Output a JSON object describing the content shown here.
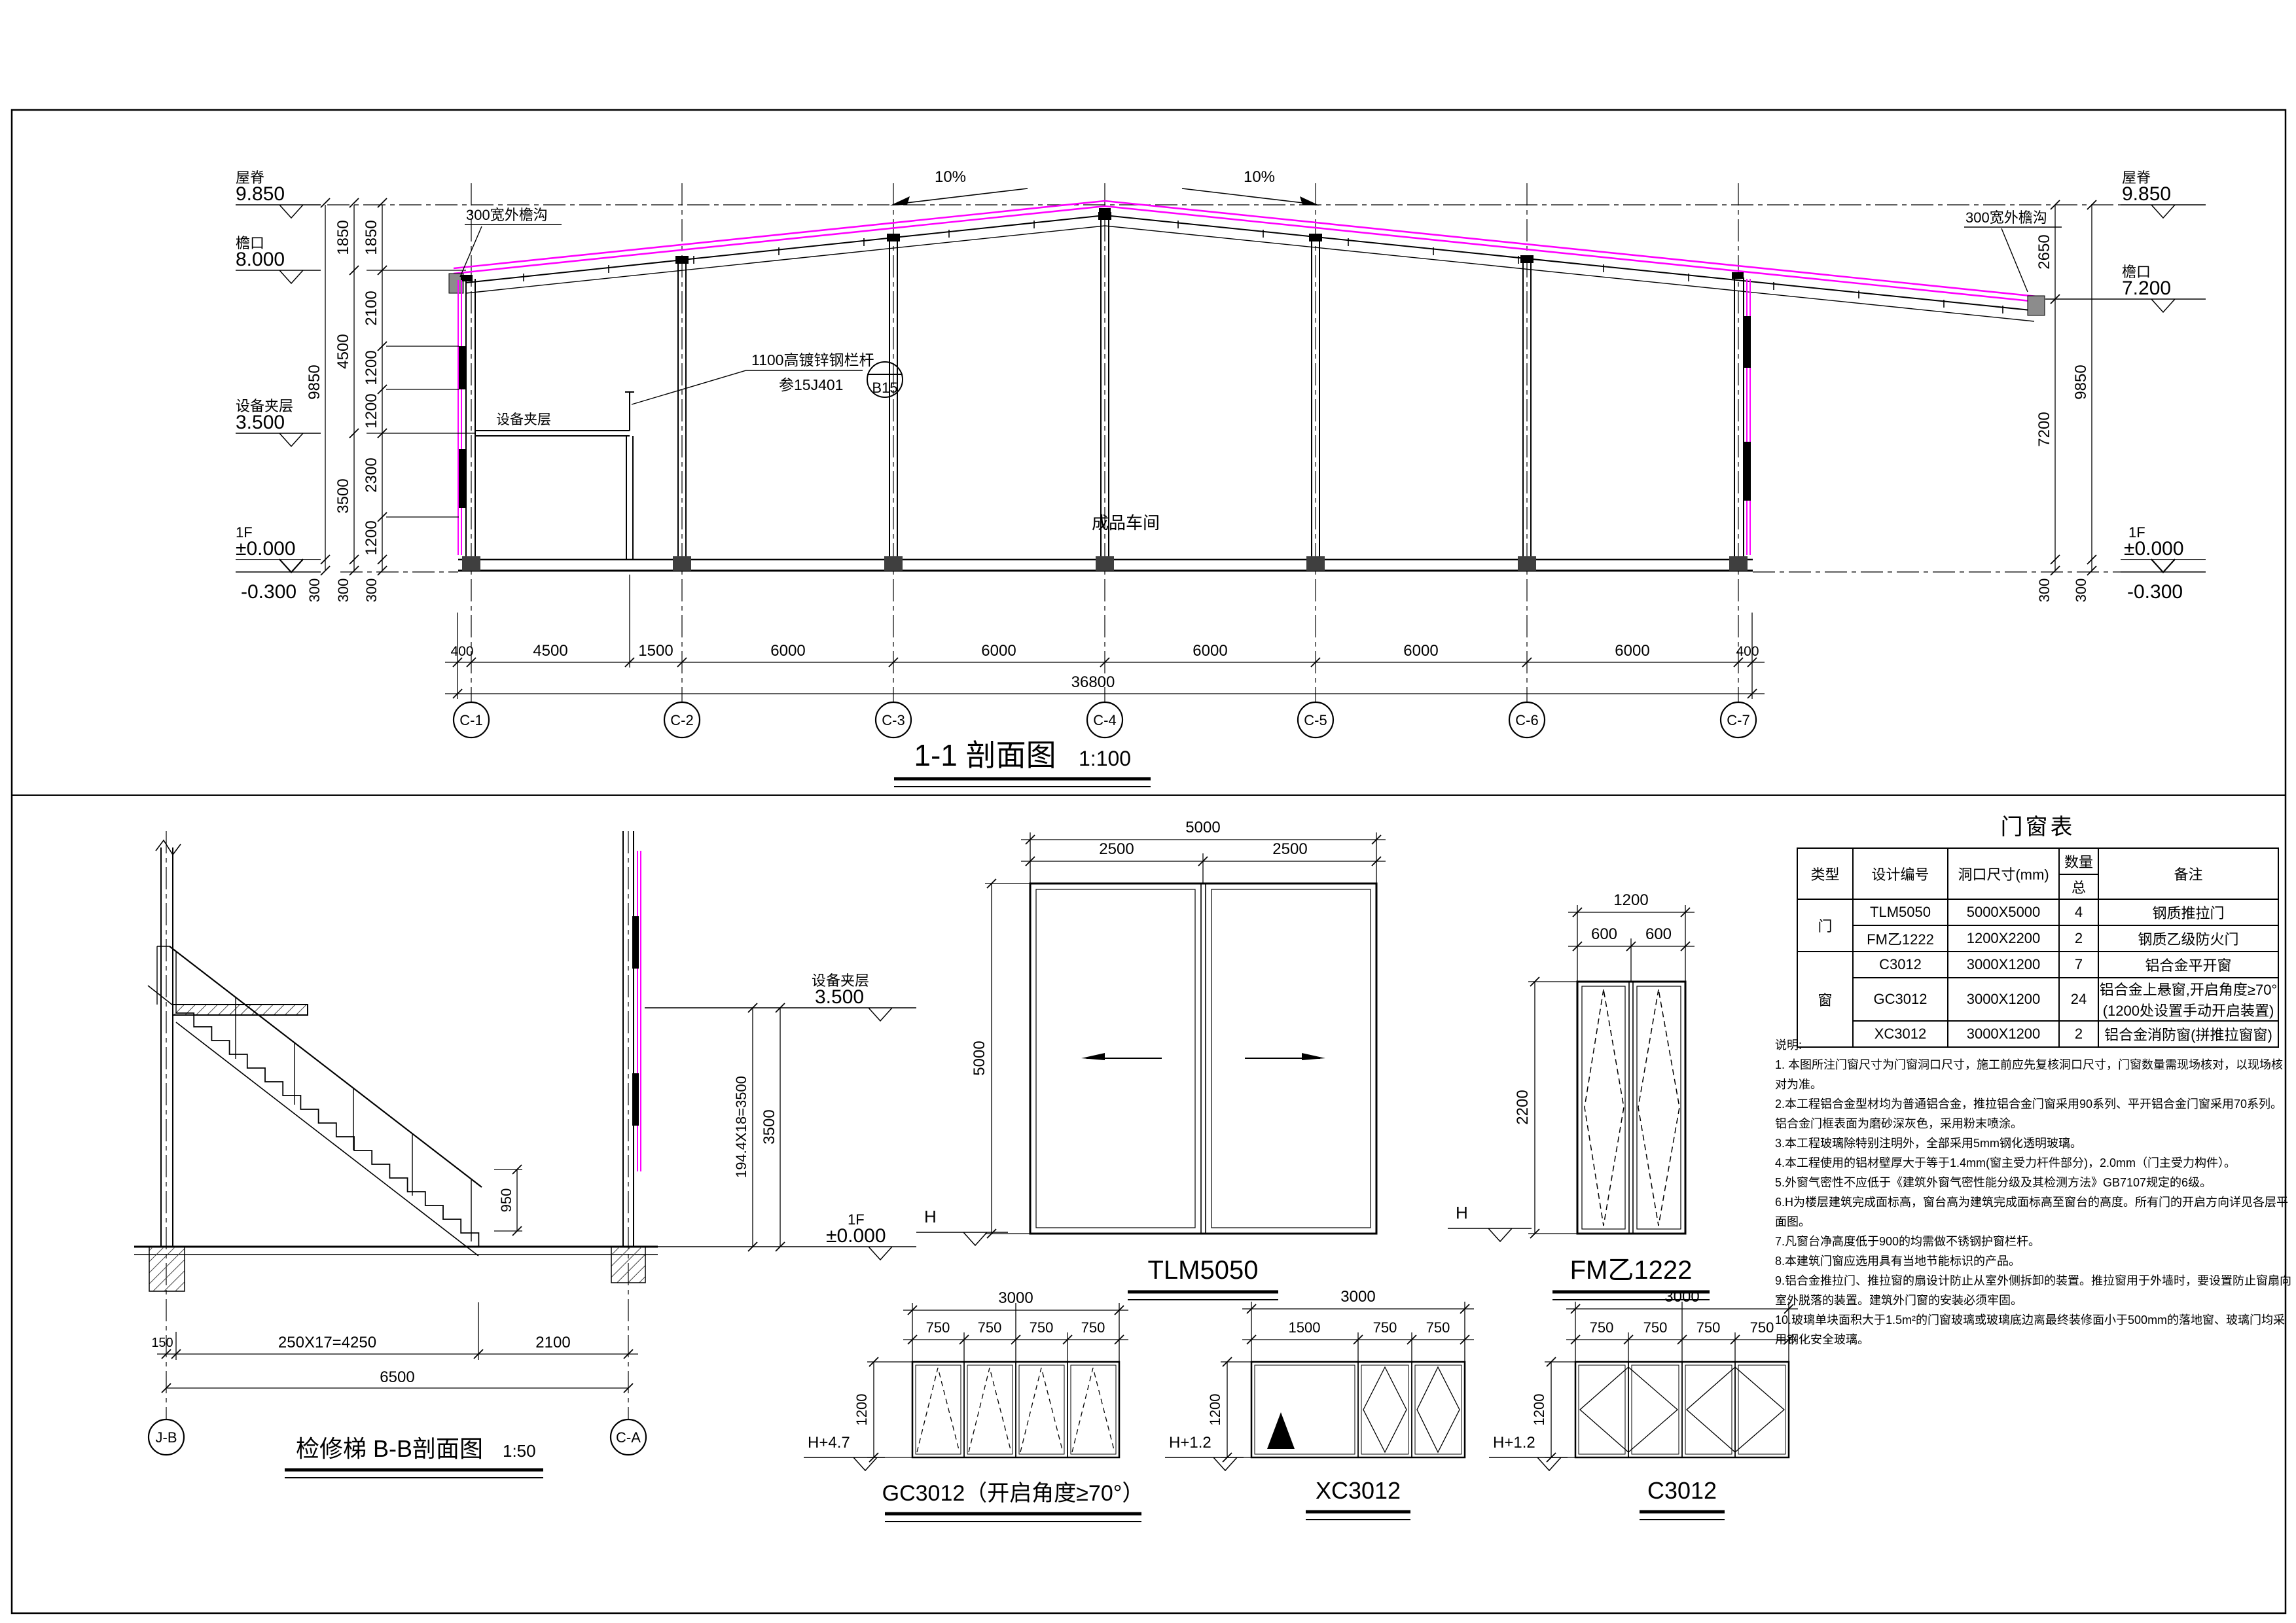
{
  "section": {
    "title": "1-1 剖面图",
    "scale": "1:100",
    "levels_left": [
      {
        "name": "屋脊",
        "value": "9.850"
      },
      {
        "name": "檐口",
        "value": "8.000"
      },
      {
        "name": "设备夹层",
        "value": "3.500"
      },
      {
        "name": "1F",
        "value": "±0.000"
      },
      {
        "name": "",
        "value": "-0.300"
      }
    ],
    "levels_right": [
      {
        "name": "屋脊",
        "value": "9.850"
      },
      {
        "name": "檐口",
        "value": "7.200"
      },
      {
        "name": "1F",
        "value": "±0.000"
      },
      {
        "name": "",
        "value": "-0.300"
      }
    ],
    "slope": "10%",
    "gutter_left": "300宽外檐沟",
    "gutter_right": "300宽外檐沟",
    "railing_note": {
      "line1": "1100高镀锌钢栏杆",
      "line2": "参15J401",
      "ref": "B15"
    },
    "mezzanine_label": "设备夹层",
    "room_label": "成品车间",
    "dims_left_outer": [
      "9850",
      "300"
    ],
    "dims_left_mid": [
      "1850",
      "4500",
      "3500",
      "300"
    ],
    "dims_left_inner": [
      "1850",
      "2100",
      "1200",
      "1200",
      "2300",
      "1200",
      "300"
    ],
    "dims_right_inner": [
      "2650",
      "7200",
      "300"
    ],
    "dims_right_outer": [
      "9850",
      "300"
    ],
    "dims_bottom": [
      "400",
      "4500",
      "1500",
      "6000",
      "6000",
      "6000",
      "6000",
      "6000",
      "400"
    ],
    "dim_total": "36800",
    "grid_bubbles": [
      "C-1",
      "C-2",
      "C-3",
      "C-4",
      "C-5",
      "C-6",
      "C-7"
    ]
  },
  "stair": {
    "title": "检修梯 B-B剖面图",
    "scale": "1:50",
    "level_mezz": {
      "name": "设备夹层",
      "value": "3.500"
    },
    "level_1f": {
      "name": "1F",
      "value": "±0.000"
    },
    "dims": {
      "offset": "150",
      "run": "250X17=4250",
      "landing": "2100",
      "total": "6500",
      "rise_steps": "194.4X18=3500",
      "rise": "3500",
      "rail_height": "950"
    },
    "grid_bubbles": [
      "J-B",
      "C-A"
    ]
  },
  "details": {
    "tlm": {
      "title": "TLM5050",
      "dim_total": "5000",
      "dim_left": "2500",
      "dim_right": "2500",
      "dim_height": "5000",
      "level": "H"
    },
    "fm": {
      "title": "FM乙1222",
      "dim_total": "1200",
      "dim_left": "600",
      "dim_right": "600",
      "dim_height": "2200",
      "level": "H"
    },
    "gc": {
      "title": "GC3012（开启角度≥70°）",
      "dim_total": "3000",
      "panels": [
        "750",
        "750",
        "750",
        "750"
      ],
      "dim_height": "1200",
      "level": "H+4.7"
    },
    "xc": {
      "title": "XC3012",
      "dim_total": "3000",
      "panels": [
        "1500",
        "750",
        "750"
      ],
      "dim_height": "1200",
      "level": "H+1.2"
    },
    "c": {
      "title": "C3012",
      "dim_total": "3000",
      "panels": [
        "750",
        "750",
        "750",
        "750"
      ],
      "dim_height": "1200",
      "level": "H+1.2"
    }
  },
  "schedule": {
    "title": "门窗表",
    "headers": {
      "type": "类型",
      "code": "设计编号",
      "size": "洞口尺寸(mm)",
      "qty": "数量",
      "qty_sub": "总",
      "remark": "备注"
    },
    "type_door": "门",
    "type_window": "窗",
    "rows": [
      {
        "code": "TLM5050",
        "size": "5000X5000",
        "qty": "4",
        "remark": "钢质推拉门"
      },
      {
        "code": "FM乙1222",
        "size": "1200X2200",
        "qty": "2",
        "remark": "钢质乙级防火门"
      },
      {
        "code": "C3012",
        "size": "3000X1200",
        "qty": "7",
        "remark": "铝合金平开窗"
      },
      {
        "code": "GC3012",
        "size": "3000X1200",
        "qty": "24",
        "remark": "铝合金上悬窗,开启角度≥70°(1200处设置手动开启装置)"
      },
      {
        "code": "XC3012",
        "size": "3000X1200",
        "qty": "2",
        "remark": "铝合金消防窗(拼推拉窗窗)"
      }
    ]
  },
  "notes": {
    "title": "说明:",
    "items": [
      "1. 本图所注门窗尺寸为门窗洞口尺寸，施工前应先复核洞口尺寸，门窗数量需现场核对，以现场核对为准。",
      "2.本工程铝合金型材均为普通铝合金，推拉铝合金门窗采用90系列、平开铝合金门窗采用70系列。铝合金门框表面为磨砂深灰色，采用粉末喷涂。",
      "3.本工程玻璃除特别注明外，全部采用5mm钢化透明玻璃。",
      "4.本工程使用的铝材壁厚大于等于1.4mm(窗主受力杆件部分)，2.0mm（门主受力构件）。",
      "5.外窗气密性不应低于《建筑外窗气密性能分级及其检测方法》GB7107规定的6级。",
      "6.H为楼层建筑完成面标高，窗台高为建筑完成面标高至窗台的高度。所有门的开启方向详见各层平面图。",
      "7.凡窗台净高度低于900的均需做不锈钢护窗栏杆。",
      "8.本建筑门窗应选用具有当地节能标识的产品。",
      "9.铝合金推拉门、推拉窗的扇设计防止从室外侧拆卸的装置。推拉窗用于外墙时，要设置防止窗扇向室外脱落的装置。建筑外门窗的安装必须牢固。",
      "10.玻璃单块面积大于1.5m²的门窗玻璃或玻璃底边离最终装修面小于500mm的落地窗、玻璃门均采用钢化安全玻璃。"
    ]
  }
}
